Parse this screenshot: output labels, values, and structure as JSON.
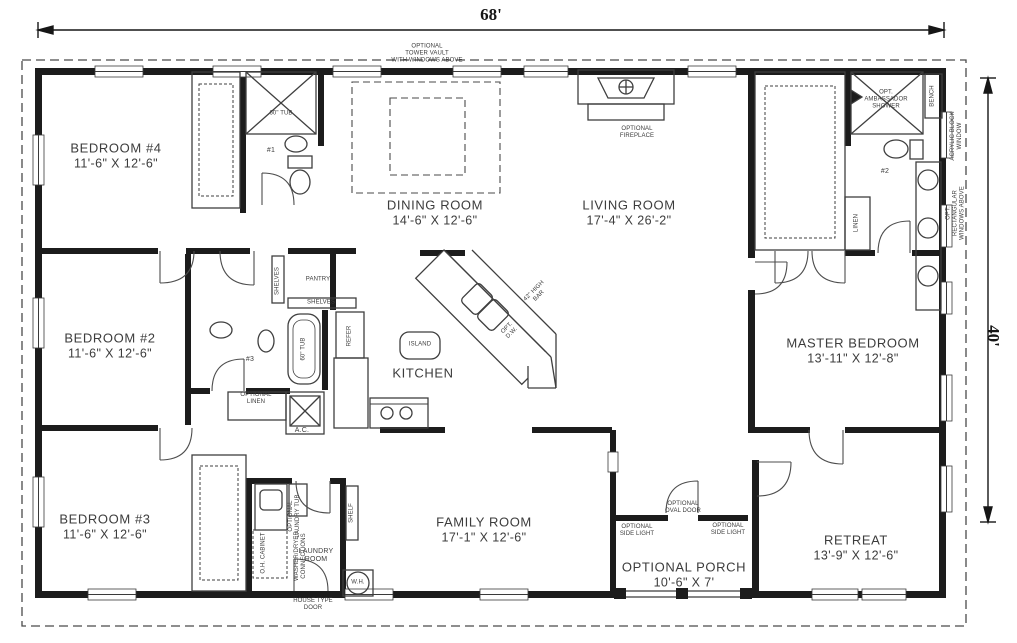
{
  "dimensions": {
    "width": "68'",
    "depth": "40'"
  },
  "rooms": {
    "bedroom4": {
      "name": "BEDROOM #4",
      "size": "11'-6\" X 12'-6\""
    },
    "dining": {
      "name": "DINING ROOM",
      "size": "14'-6\" X 12'-6\""
    },
    "living": {
      "name": "LIVING ROOM",
      "size": "17'-4\" X 26'-2\""
    },
    "master": {
      "name": "MASTER BEDROOM",
      "size": "13'-11\" X 12'-8\""
    },
    "bedroom2": {
      "name": "BEDROOM #2",
      "size": "11'-6\" X 12'-6\""
    },
    "kitchen": {
      "name": "KITCHEN"
    },
    "bedroom3": {
      "name": "BEDROOM #3",
      "size": "11'-6\" X 12'-6\""
    },
    "laundry": {
      "name": "LAUNDRY\nROOM"
    },
    "family": {
      "name": "FAMILY ROOM",
      "size": "17'-1\" X 12'-6\""
    },
    "porch": {
      "name": "OPTIONAL PORCH",
      "size": "10'-6\" X 7'"
    },
    "retreat": {
      "name": "RETREAT",
      "size": "13'-9\" X 12'-6\""
    }
  },
  "notes": {
    "tower_vault": "OPTIONAL\nTOWER VAULT\nWITH WINDOWS ABOVE",
    "fireplace": "OPTIONAL\nFIREPLACE",
    "ambassador_shower": "OPT.\nAMBASSADOR\nSHOWER",
    "bench": "BENCH",
    "bath1": "#1",
    "bath2": "#2",
    "bath3": "#3",
    "tub_bath1": "60\" TUB",
    "tub_bath3": "60\" TUB",
    "linen_master": "LINEN",
    "acrylic_window": "ACRYLIC BLOCK\nWINDOW",
    "rect_windows": "OPT. RECTANGULAR\nWINDOWS ABOVE",
    "shelves_vert": "SHELVES",
    "pantry": "PANTRY",
    "shelves_horiz": "SHELVES",
    "refer": "REFER",
    "island": "ISLAND",
    "high_bar": "42\" HIGH\nBAR",
    "opt_dw": "OPT.\nD.W.",
    "optional_linen": "OPTIONAL\nLINEN",
    "ac": "A.C.",
    "oh_cabinet": "O.H. CABINET",
    "washer_dryer": "WASHER/DRYER\nCONNECTIONS",
    "laundry_tub": "OPTIONAL\nLAUNDRY TUB",
    "shelf": "SHELF",
    "water_heater": "W.H.",
    "house_door": "HOUSE TYPE\nDOOR",
    "oval_door": "OPTIONAL\nOVAL DOOR",
    "side_light_left": "OPTIONAL\nSIDE LIGHT",
    "side_light_right": "OPTIONAL\nSIDE LIGHT"
  },
  "colors": {
    "wall": "#1c1c1c",
    "line": "#4d4d4d",
    "text": "#3c3c3c"
  }
}
